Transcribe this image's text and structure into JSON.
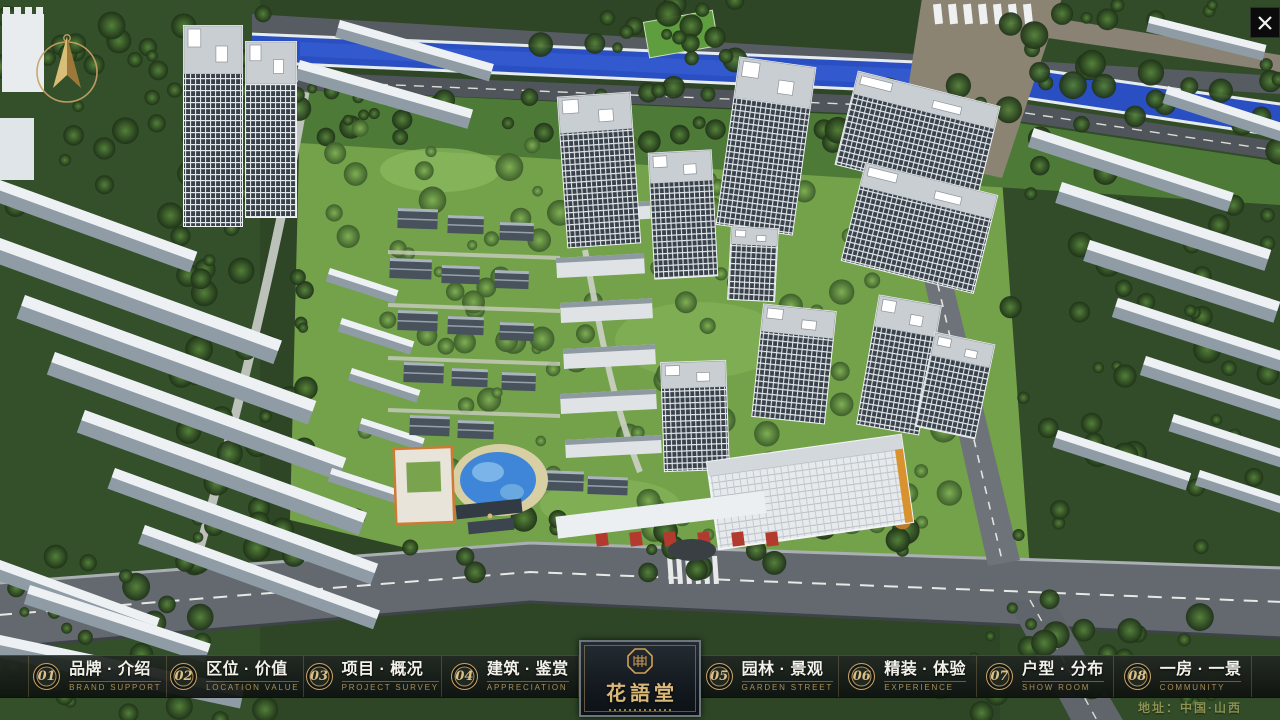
{
  "window": {
    "icons": {
      "close": "✕",
      "compass": "compass-north-arrow",
      "seal": "octagonal-seal"
    }
  },
  "navbar": {
    "items": [
      {
        "num": "01",
        "zh": "品牌 · 介绍",
        "en": "BRAND SUPPORT"
      },
      {
        "num": "02",
        "zh": "区位 · 价值",
        "en": "LOCATION VALUE"
      },
      {
        "num": "03",
        "zh": "项目 · 概况",
        "en": "PROJECT SURVEY"
      },
      {
        "num": "04",
        "zh": "建筑 · 鉴赏",
        "en": "APPRECIATION"
      },
      {
        "num": "05",
        "zh": "园林 · 景观",
        "en": "GARDEN STREET"
      },
      {
        "num": "06",
        "zh": "精装 · 体验",
        "en": "EXPERIENCE"
      },
      {
        "num": "07",
        "zh": "户型 · 分布",
        "en": "SHOW ROOM"
      },
      {
        "num": "08",
        "zh": "一房 · 一景",
        "en": "COMMUNITY"
      }
    ]
  },
  "logo": {
    "title": "花語堂"
  },
  "footer": {
    "address": "地址：中国·山西"
  },
  "scene": {
    "colors": {
      "gold": "#c9a368",
      "gold_bright": "#dcc08a",
      "nav_bg": "#14190f",
      "river_blue": "#2a4fc2",
      "pool_blue": "#3f86d8",
      "road_grey": "#63696e",
      "bridge_tan": "#8b8473",
      "grass_green": "#74a24b",
      "tree_green": "#2c4423",
      "building_white": "#e9edf0",
      "roof_slate": "#47525c",
      "accent_red": "#b23a2e",
      "accent_orange": "#d8922f"
    }
  }
}
